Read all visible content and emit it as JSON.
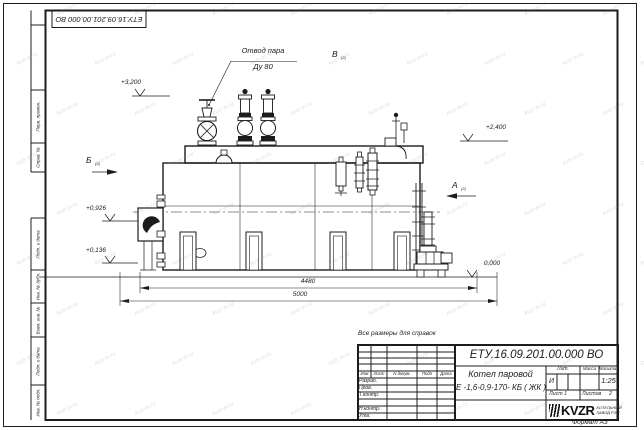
{
  "sheet": {
    "watermark": "kvzr-m.ru",
    "format_note": "Формат А3",
    "reference_note": "Все размеры для справок",
    "top_stamp": "ЕТУ.16.09.201.00.000  ВО"
  },
  "margin": {
    "items": [
      "Перв. примен.",
      "Справ. №",
      "Подп. и дата",
      "Инв. № дубл.",
      "Взам. инв. №",
      "Подп. и дата",
      "Инв. № подл."
    ]
  },
  "drawing": {
    "callout": {
      "line1": "Отвод пара",
      "line2": "Ду 80"
    },
    "views": {
      "a": "А",
      "b": "Б",
      "v": "В",
      "ref": "(2)"
    },
    "elevations": [
      "+3,200",
      "+2,400",
      "+0,926",
      "+0,136",
      "0,000"
    ],
    "dimensions": [
      "4480",
      "5000"
    ]
  },
  "title_block": {
    "doc_number": "ЕТУ.16.09.201.00.000  ВО",
    "product_name_line1": "Котел паровой",
    "product_name_line2": "Е -1,6-0,9-170- КБ ( ЖК )",
    "columns": {
      "izm": "Изм",
      "list": "Лист",
      "doc": "N докум.",
      "sign": "Подп",
      "date": "Дата"
    },
    "rows": [
      "Разраб.",
      "Пров.",
      "Т.контр.",
      "",
      "Н.контр.",
      "Утв."
    ],
    "lit_label": "Лит.",
    "lit_value": "И",
    "mass_label": "Масса",
    "scale_label": "Масштаб",
    "scale_value": "1:25",
    "sheet_label": "Лист 1",
    "sheets_word": "Листов",
    "sheets_value": "2",
    "logo": {
      "text": "KVZR",
      "sub1": "КОТЕЛЬНЫЙ",
      "sub2": "ЗАВОД РЭП"
    }
  }
}
